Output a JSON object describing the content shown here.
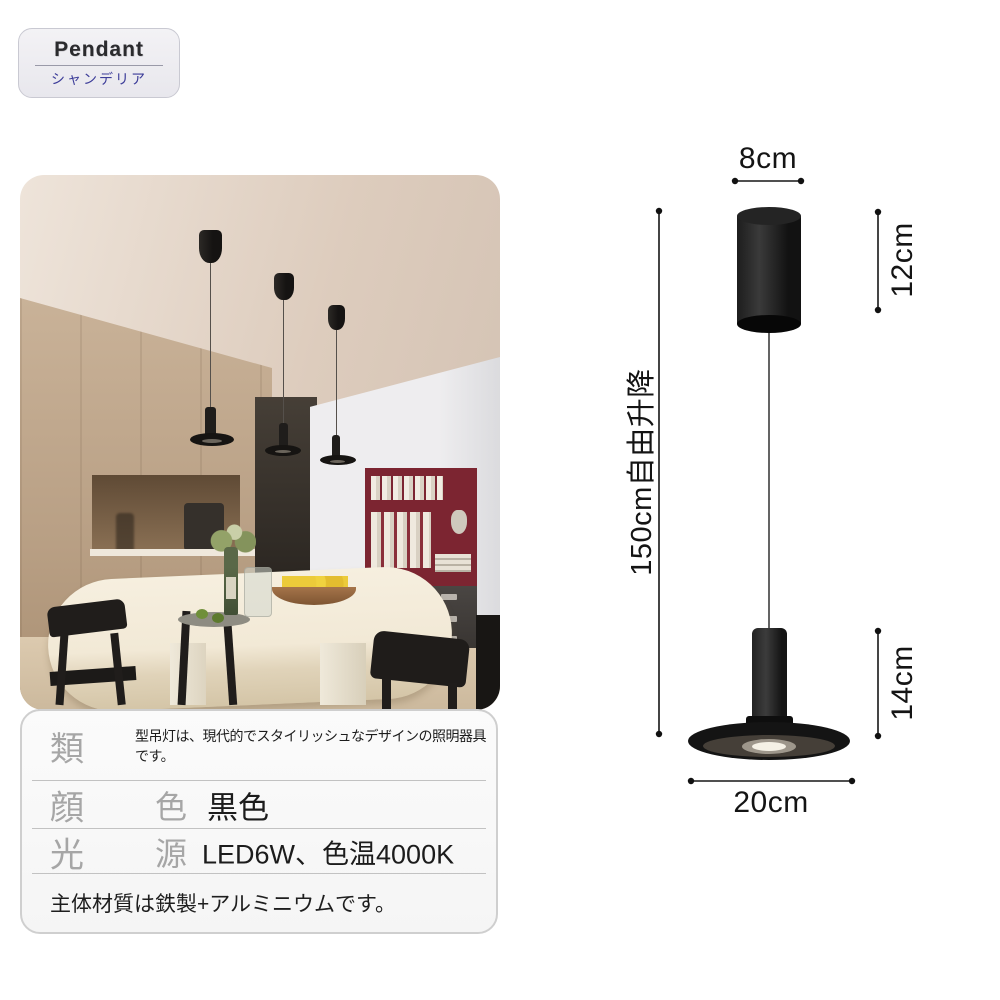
{
  "badge": {
    "brand": "Pendant",
    "subtitle": "シャンデリア"
  },
  "diagram": {
    "canopy_width": "8cm",
    "canopy_height": "12cm",
    "cable_length": "150cm自由升降",
    "lamp_height": "14cm",
    "shade_diameter": "20cm"
  },
  "specs": {
    "rows": [
      {
        "label": "類",
        "label2": "",
        "value": "型吊灯は、現代的でスタイリッシュなデザインの照明器具です。"
      },
      {
        "label": "顔",
        "label2": "色",
        "value": "黒色"
      },
      {
        "label": "光",
        "label2": "源",
        "value": "LED6W、色温4000K"
      }
    ],
    "material_note": "主体材質は鉄製+アルミニウムです。"
  },
  "colors": {
    "subtitle_blue": "#3c3c99",
    "label_gray": "#a6a6a6",
    "diagram_ink": "#141414",
    "lamp_black": "#141412"
  }
}
